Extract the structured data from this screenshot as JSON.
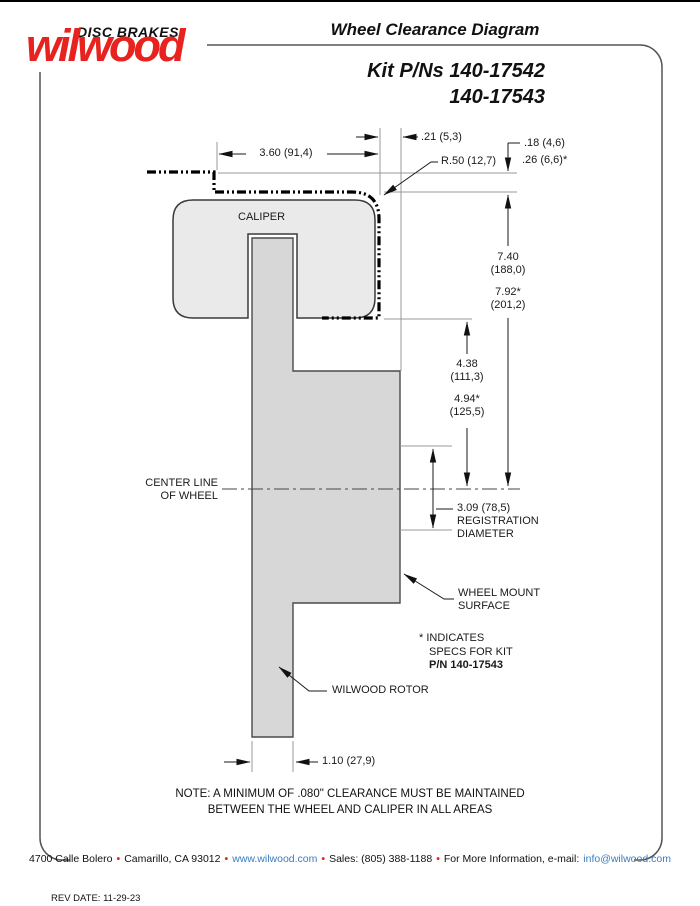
{
  "header": {
    "brand_top": "DISC BRAKES",
    "brand_script": "wilwood",
    "title": "Wheel Clearance Diagram",
    "kit_line1": "Kit P/Ns 140-17542",
    "kit_line2": "140-17543"
  },
  "colors": {
    "brand_red": "#e8231f",
    "link_blue": "#3a7dbf",
    "caliper_fill": "#eaeaea",
    "rotor_fill": "#d7d7d7"
  },
  "diagram": {
    "caliper_label": "CALIPER",
    "center_line": {
      "l1": "CENTER LINE",
      "l2": "OF WHEEL"
    },
    "registration": {
      "l1": "3.09 (78,5)",
      "l2": "REGISTRATION",
      "l3": "DIAMETER"
    },
    "wheel_mount": {
      "l1": "WHEEL MOUNT",
      "l2": "SURFACE"
    },
    "rotor_label": "WILWOOD ROTOR",
    "spec_note": {
      "l1": "* INDICATES",
      "l2": "SPECS FOR KIT",
      "l3": "P/N 140-17543"
    },
    "dims": {
      "width_top": "3.60 (91,4)",
      "offset_21": ".21 (5,3)",
      "radius_50": "R.50 (12,7)",
      "clear_18": ".18 (4,6)",
      "clear_26": ".26 (6,6)*",
      "h740_a": "7.40",
      "h740_b": "(188,0)",
      "h792_a": "7.92*",
      "h792_b": "(201,2)",
      "h438_a": "4.38",
      "h438_b": "(111,3)",
      "h494_a": "4.94*",
      "h494_b": "(125,5)",
      "rotor_width": "1.10 (27,9)"
    }
  },
  "note": {
    "line1": "NOTE: A MINIMUM OF .080\" CLEARANCE MUST BE MAINTAINED",
    "line2": "BETWEEN THE WHEEL AND CALIPER IN ALL AREAS"
  },
  "footer": {
    "address": "4700 Calle Bolero",
    "city": "Camarillo, CA 93012",
    "web": "www.wilwood.com",
    "sales": "Sales: (805) 388-1188",
    "info_label": "For More Information, e-mail:",
    "email": "info@wilwood.com",
    "bullet": "•",
    "rev": "REV DATE:  11-29-23"
  }
}
